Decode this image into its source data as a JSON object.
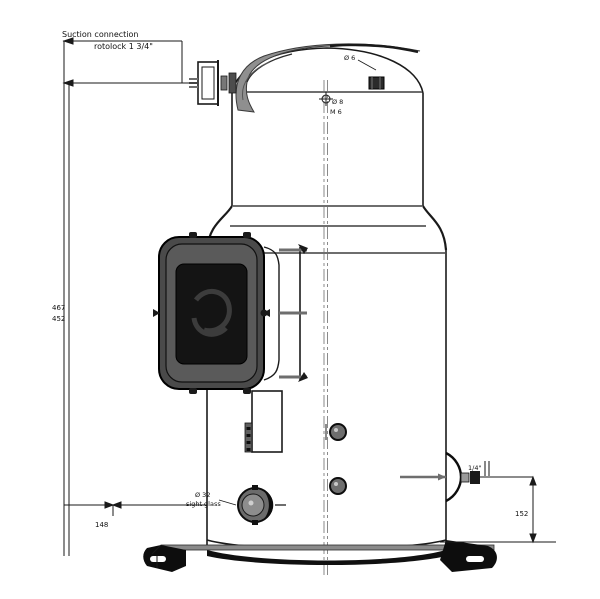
{
  "drawing": {
    "title": "Compressor outline dimensional drawing",
    "labels": {
      "suction": {
        "line1": "Suction connection",
        "line2": "rotolock 1 3/4\""
      },
      "dome_port": "Ø 6",
      "center_target_line1": "Ø 8",
      "center_target_line2": "M 6",
      "discharge_size": "1/4\"",
      "discharge_height": "152",
      "dim_height_overall": "467",
      "dim_height_suction": "452",
      "dim_base_left": "148",
      "sight_glass_line1": "Ø 32",
      "sight_glass_line2": "sight glass"
    },
    "colors": {
      "line": "#1a1a1a",
      "seam_gray": "#6e6e6e",
      "shade_light": "#9a9a9a",
      "shade_mid": "#555555",
      "shade_dark": "#2b2b2b",
      "background": "#ffffff"
    }
  }
}
